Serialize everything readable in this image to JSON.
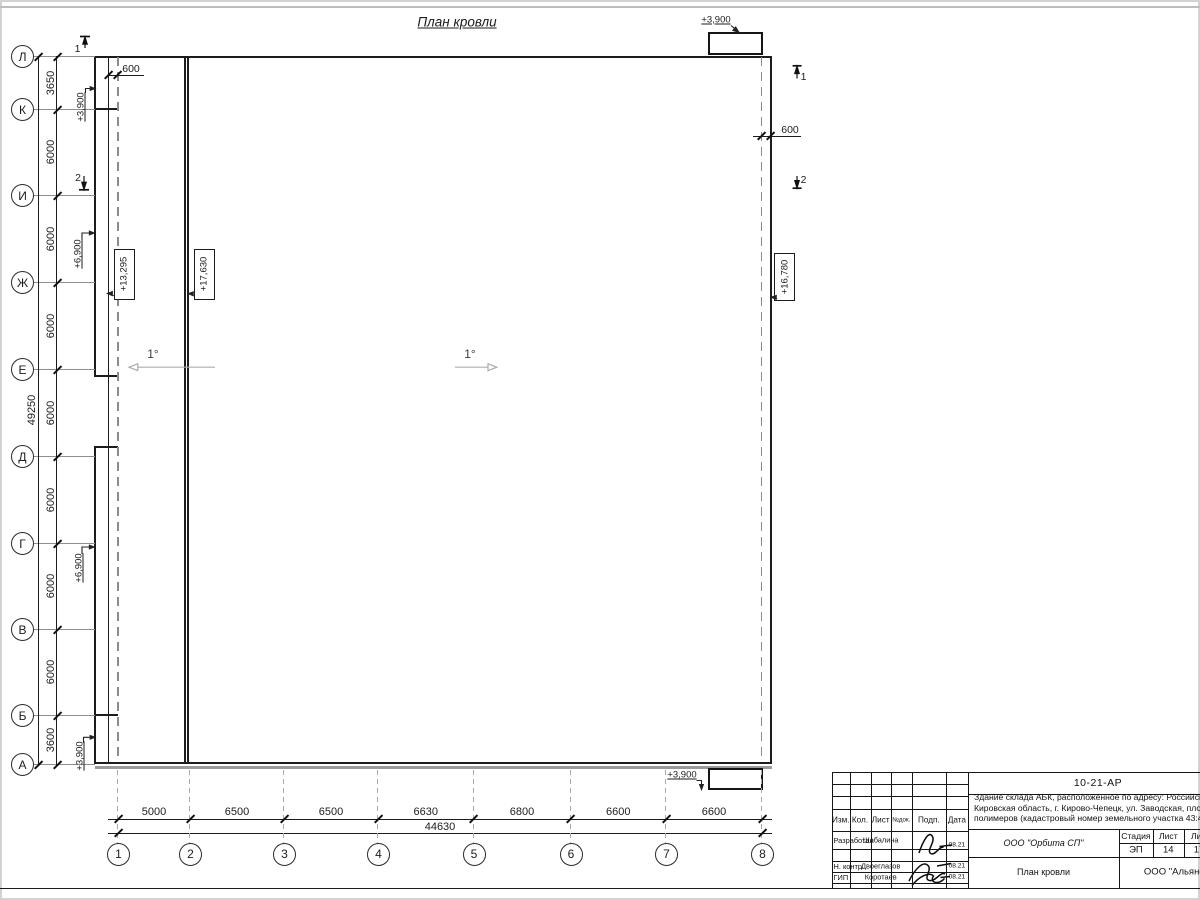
{
  "colors": {
    "line": "#1c1c1c",
    "aux": "#8c8c8c"
  },
  "drawing": {
    "title": "План кровли",
    "slope_left": "1°",
    "slope_main": "1°",
    "dim_600_left": "600",
    "dim_600_right": "600",
    "elev_canopy_top": "+3,900",
    "elev_canopy_bottom": "+3,900",
    "elev_entry_k": "+3,900",
    "elev_entry_a": "+3,900",
    "elev_mid_zh": "+6,900",
    "elev_mid_g": "+6,900",
    "elev_strip_roof": "+13,295",
    "elev_main_roof_high": "+17,630",
    "elev_main_roof_low": "+16,780",
    "section_1": "1",
    "section_2": "2"
  },
  "row_axes": [
    "Л",
    "К",
    "И",
    "Ж",
    "Е",
    "Д",
    "Г",
    "В",
    "Б",
    "А"
  ],
  "row_dims": [
    "3650",
    "6000",
    "6000",
    "6000",
    "6000",
    "6000",
    "6000",
    "6000",
    "3600"
  ],
  "row_total": "49250",
  "col_axes": [
    "1",
    "2",
    "3",
    "4",
    "5",
    "6",
    "7",
    "8"
  ],
  "col_dims": [
    "5000",
    "6500",
    "6500",
    "6630",
    "6800",
    "6600",
    "6600"
  ],
  "col_total": "44630",
  "titleblock": {
    "doc_number": "10-21-АР",
    "desc_line1": "Здание склада АБК, расположенное по адресу: Российская Феде",
    "desc_line2": "Кировская область, г. Кирово-Чепецк, ул. Заводская, площадка з",
    "desc_line3": "полимеров (кадастровый номер земельного участка 43:42:00000",
    "col_izm": "Изм.",
    "col_kol": "Кол.",
    "col_list": "Лист",
    "col_ndok": "№док.",
    "col_podp": "Подп.",
    "col_data": "Дата",
    "rows": [
      {
        "role": "Разработал",
        "name": "Шабалина",
        "date": "08.21"
      },
      {
        "role": "Н. контр.",
        "name": "Двоеглазов",
        "date": "08.21"
      },
      {
        "role": "ГИП",
        "name": "Коротаев",
        "date": "08.21"
      }
    ],
    "company": "ООО \"Орбита СП\"",
    "stage_label": "Стадия",
    "list_label": "Лист",
    "listov_label": "Листов",
    "stage": "ЭП",
    "sheet_no": "14",
    "sheets_total": "17",
    "drawing_name": "План кровли",
    "contractor": "ООО \"Альянс"
  }
}
